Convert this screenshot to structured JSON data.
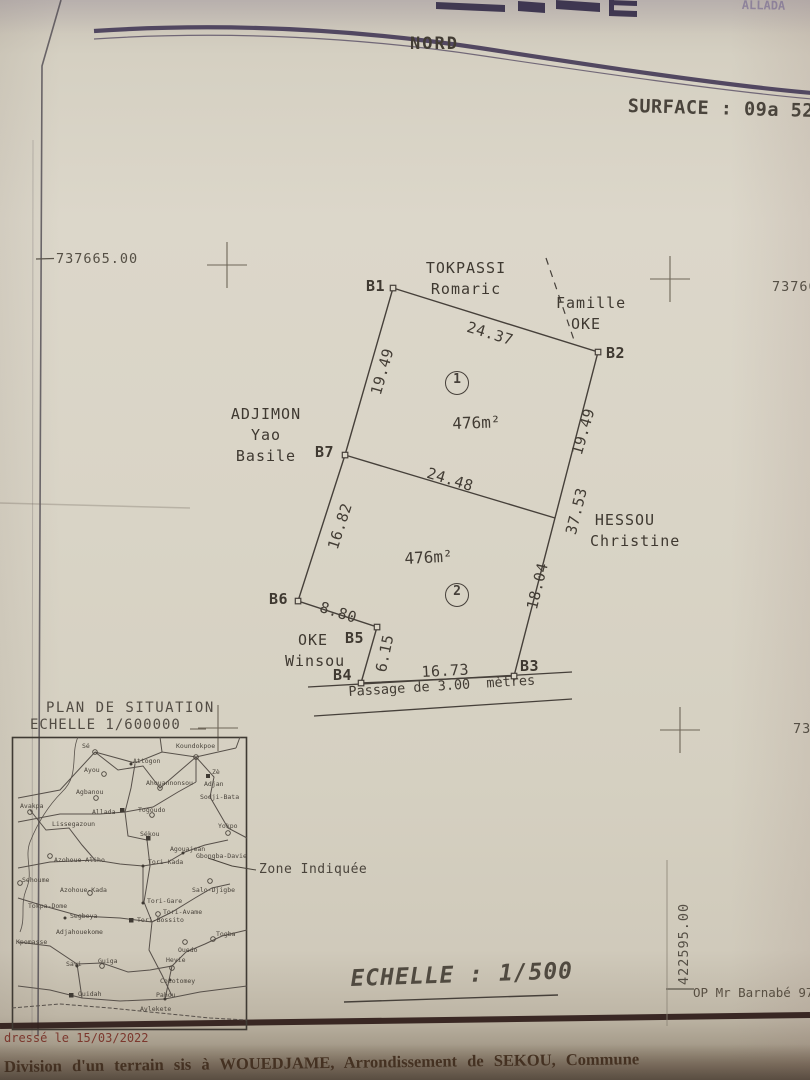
{
  "header": {
    "nord": "NORD",
    "surface": "SURFACE :  09a 52c",
    "top_right_fragment": "ALLADA"
  },
  "grid": {
    "labels": [
      {
        "text": "737665.00",
        "x": 56,
        "y": 251,
        "rot": 0
      },
      {
        "text": "737665",
        "x": 772,
        "y": 279,
        "rot": 0
      },
      {
        "text": "737",
        "x": 793,
        "y": 721,
        "rot": 0
      },
      {
        "text": "422595.00",
        "x": 676,
        "y": 985,
        "rot": -90
      }
    ]
  },
  "plan": {
    "vertex_labels": [
      {
        "text": "B1",
        "x": 366,
        "y": 277
      },
      {
        "text": "B2",
        "x": 606,
        "y": 344
      },
      {
        "text": "B3",
        "x": 520,
        "y": 657
      },
      {
        "text": "B4",
        "x": 333,
        "y": 666
      },
      {
        "text": "B5",
        "x": 345,
        "y": 629
      },
      {
        "text": "B6",
        "x": 269,
        "y": 590
      },
      {
        "text": "B7",
        "x": 315,
        "y": 443
      }
    ],
    "dim_labels": [
      {
        "text": "24.37",
        "x": 470,
        "y": 318,
        "rot": 17
      },
      {
        "text": "19.49",
        "x": 367,
        "y": 392,
        "rot": -74
      },
      {
        "text": "19.49",
        "x": 568,
        "y": 452,
        "rot": -74
      },
      {
        "text": "24.48",
        "x": 430,
        "y": 464,
        "rot": 17
      },
      {
        "text": "37.53",
        "x": 562,
        "y": 532,
        "rot": -76
      },
      {
        "text": "16.82",
        "x": 324,
        "y": 546,
        "rot": -72
      },
      {
        "text": "18.04",
        "x": 523,
        "y": 607,
        "rot": -76
      },
      {
        "text": "8.80",
        "x": 323,
        "y": 598,
        "rot": 18
      },
      {
        "text": "6.15",
        "x": 372,
        "y": 670,
        "rot": -78
      },
      {
        "text": "16.73",
        "x": 421,
        "y": 663,
        "rot": -3
      }
    ],
    "area_labels": [
      {
        "text": "476m²",
        "x": 452,
        "y": 414,
        "rot": -2
      },
      {
        "text": "476m²",
        "x": 404,
        "y": 549,
        "rot": -3
      }
    ],
    "parcel_numbers": [
      {
        "text": "1",
        "cx": 456,
        "cy": 382
      },
      {
        "text": "2",
        "cx": 456,
        "cy": 594
      }
    ],
    "neighbors": [
      {
        "lines": [
          "TOKPASSI",
          "Romaric"
        ],
        "x": 420,
        "y": 258,
        "w": 92
      },
      {
        "lines": [
          "Famille",
          "OKE"
        ],
        "x": 556,
        "y": 293,
        "w": 60
      },
      {
        "lines": [
          "ADJIMON",
          "Yao Basile"
        ],
        "x": 226,
        "y": 404,
        "w": 80
      },
      {
        "lines": [
          "HESSOU",
          "Christine"
        ],
        "x": 590,
        "y": 510,
        "w": 70
      },
      {
        "lines": [
          "OKE",
          "Winsou"
        ],
        "x": 285,
        "y": 630,
        "w": 56
      }
    ],
    "passage_label": "Passage de 3.00  mètres"
  },
  "situation": {
    "title": "PLAN DE SITUATION",
    "scale": "ECHELLE 1/600000",
    "zone_label": "Zone Indiquée",
    "places": [
      {
        "n": "Sé",
        "x": 82,
        "y": 742
      },
      {
        "n": "Koundokpoe",
        "x": 176,
        "y": 742
      },
      {
        "n": "Ayou",
        "x": 84,
        "y": 766
      },
      {
        "n": "Attogon",
        "x": 133,
        "y": 757
      },
      {
        "n": "Ahouannonsou",
        "x": 146,
        "y": 779
      },
      {
        "n": "Zè",
        "x": 212,
        "y": 768
      },
      {
        "n": "Adjan",
        "x": 204,
        "y": 780
      },
      {
        "n": "Sodji-Bata",
        "x": 200,
        "y": 793
      },
      {
        "n": "Agbanou",
        "x": 76,
        "y": 788
      },
      {
        "n": "Togoudo",
        "x": 138,
        "y": 806
      },
      {
        "n": "Allada",
        "x": 92,
        "y": 808
      },
      {
        "n": "Avakpa",
        "x": 20,
        "y": 802
      },
      {
        "n": "Lissegazoun",
        "x": 52,
        "y": 820
      },
      {
        "n": "Yokpo",
        "x": 218,
        "y": 822
      },
      {
        "n": "Sékou",
        "x": 140,
        "y": 830
      },
      {
        "n": "Azohoue-Aliho",
        "x": 54,
        "y": 856
      },
      {
        "n": "Agouajean",
        "x": 170,
        "y": 845
      },
      {
        "n": "Gbongba-Davie",
        "x": 196,
        "y": 852
      },
      {
        "n": "Tori-Kada",
        "x": 148,
        "y": 858
      },
      {
        "n": "Sehoume",
        "x": 22,
        "y": 876
      },
      {
        "n": "Azohoue-Kada",
        "x": 60,
        "y": 886
      },
      {
        "n": "Salo-Djigbe",
        "x": 192,
        "y": 886
      },
      {
        "n": "Tori-Gare",
        "x": 147,
        "y": 897
      },
      {
        "n": "Tori-Avame",
        "x": 163,
        "y": 908
      },
      {
        "n": "Tori-Bossito",
        "x": 137,
        "y": 916
      },
      {
        "n": "Tokpa-Dome",
        "x": 28,
        "y": 902
      },
      {
        "n": "Segbeya",
        "x": 70,
        "y": 912
      },
      {
        "n": "Kpomasse",
        "x": 16,
        "y": 938
      },
      {
        "n": "Adjahouekome",
        "x": 56,
        "y": 928
      },
      {
        "n": "Savi",
        "x": 66,
        "y": 960
      },
      {
        "n": "Guiga",
        "x": 98,
        "y": 957
      },
      {
        "n": "Ouedo",
        "x": 178,
        "y": 946
      },
      {
        "n": "Hevie",
        "x": 166,
        "y": 956
      },
      {
        "n": "Togba",
        "x": 216,
        "y": 930
      },
      {
        "n": "Cocotomey",
        "x": 160,
        "y": 977
      },
      {
        "n": "Ouidah",
        "x": 78,
        "y": 990
      },
      {
        "n": "Pahou",
        "x": 156,
        "y": 991
      },
      {
        "n": "Avlekete",
        "x": 140,
        "y": 1005
      }
    ]
  },
  "footer": {
    "scale": "ECHELLE : 1/500",
    "surveyor": "OP Mr Barnabé 97",
    "date": "dressé le 15/03/2022",
    "bottom_text": "Division d'un terrain sis à WOUEDJAME, Arrondissement de SEKOU, Commune"
  }
}
